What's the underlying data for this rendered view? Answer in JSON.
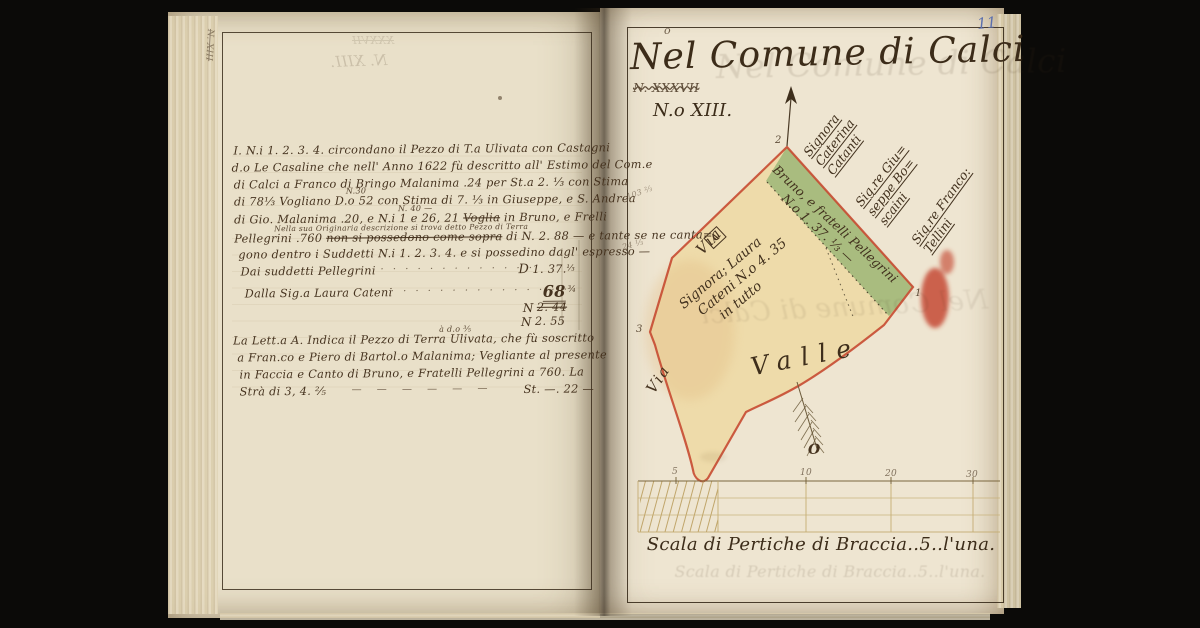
{
  "page_number": "11",
  "colors": {
    "paper": "#ece3cf",
    "ink": "#46331f",
    "parcel_green": "#a4bb7c",
    "parcel_yellow": "#eedaa6",
    "border_red": "#c64a31",
    "page_number_blue": "#5b6fae"
  },
  "left_page": {
    "edge_mark": "N. XIII",
    "bleed_strike": "XXXVII",
    "bleed_title": "N. XIII.",
    "para1": {
      "l1": "I. N.i 1. 2. 3. 4. circondano il Pezzo di T.a Ulivata con Castagni",
      "l2": "d.o Le Casaline che nell' Anno 1622 fù descritto all' Estimo del Com.e",
      "l3": "di Calci a Franco di Bringo Malanima .24 per St.a 2. ⅓ con Stima",
      "l4": "di 78⅓ Vogliano D.o 52 con Stima di 7. ⅓ in Giuseppe, e S. Andrea",
      "l4_insert": "N.30",
      "l5_pre": "di Gio. Malanima .20, e N.i 1 e 26, 21 ",
      "l5_struck": "Voglia",
      "l5_post": " in Bruno, e Frelli",
      "l5_insert": "N. 40 —",
      "l6_insert": "Nella sua Originaria descrizione si trova detto Pezzo di Terra",
      "l6_pre": "Pellegrini .760 ",
      "l6_struck": "non si possedono come sopra",
      "l6_post": " di N. 2. 88 — e tante se ne canta=",
      "l7": "gono dentro i Suddetti N.i 1. 2. 3. 4. e si possedino dagl' espresso —"
    },
    "totals": {
      "row1_label": "Dai suddetti Pellegrini",
      "row1_leader": "· · · · · · · · · · · · ·",
      "row1_currency": "D",
      "row1_amount": "1. 37.",
      "row1_frac": "⅓",
      "row2_label": "Dalla Sig.a Laura Cateni",
      "row2_leader": "· · · · · · · · · · · · · · ·",
      "row2_amount": "68",
      "row2_frac": "¾",
      "row3_prefix": "N",
      "row3_amount": "2. 44",
      "row4_prefix": "N",
      "row4_amount": "2. 55"
    },
    "para2": {
      "l1": "La Lett.a A. Indica il Pezzo di Terra Ulivata, che fù soscritto",
      "l1_insert": "à d.o ⅗",
      "l2": "a Fran.co e Piero di Bartol.o Malanima; Vegliante al presente",
      "l3": "in Faccia e Canto di Bruno, e Fratelli Pellegrini a 760. La",
      "l4": "Strà di 3, 4. ⅖",
      "l4_leader": "—   —   —   —   —   —",
      "l4_amount": "St. —. 22 —"
    }
  },
  "right_page": {
    "title": "Nel Comune di Calci",
    "title_superscript": "o",
    "struck_number": "N. XXXVII",
    "sheet_number": "N.o XIII.",
    "map": {
      "via_upper": "Via",
      "via_lower": "Via",
      "valle": "Valle",
      "compass_letter": "O",
      "parcel_letter": "A",
      "corner_1": "1",
      "corner_2": "2",
      "corner_3": "3",
      "neighbors": [
        {
          "l1": "Signora",
          "l2": "Caterina",
          "l3": "Catanti"
        },
        {
          "l1": "Sig.re Giu=",
          "l2": "seppe Bo=",
          "l3": "scaini"
        },
        {
          "l1": "Sig.re Franco:",
          "l2": "Tellini",
          "l3": ""
        }
      ],
      "green_label": {
        "l1": "Bruno, e fratelli Pellegrini",
        "l2": "N.o 1. 37. ⅓ —"
      },
      "yellow_label": {
        "l1": "Signora; Laura",
        "l2": "Cateni N.o 4. 35",
        "l3": "in tutto"
      },
      "note1": "103 ⅔",
      "note2": "24 ⅓"
    },
    "scale": {
      "ticks": [
        "5",
        "10",
        "20",
        "30"
      ],
      "caption": "Scala di Pertiche di Braccia..5..l'una."
    }
  }
}
